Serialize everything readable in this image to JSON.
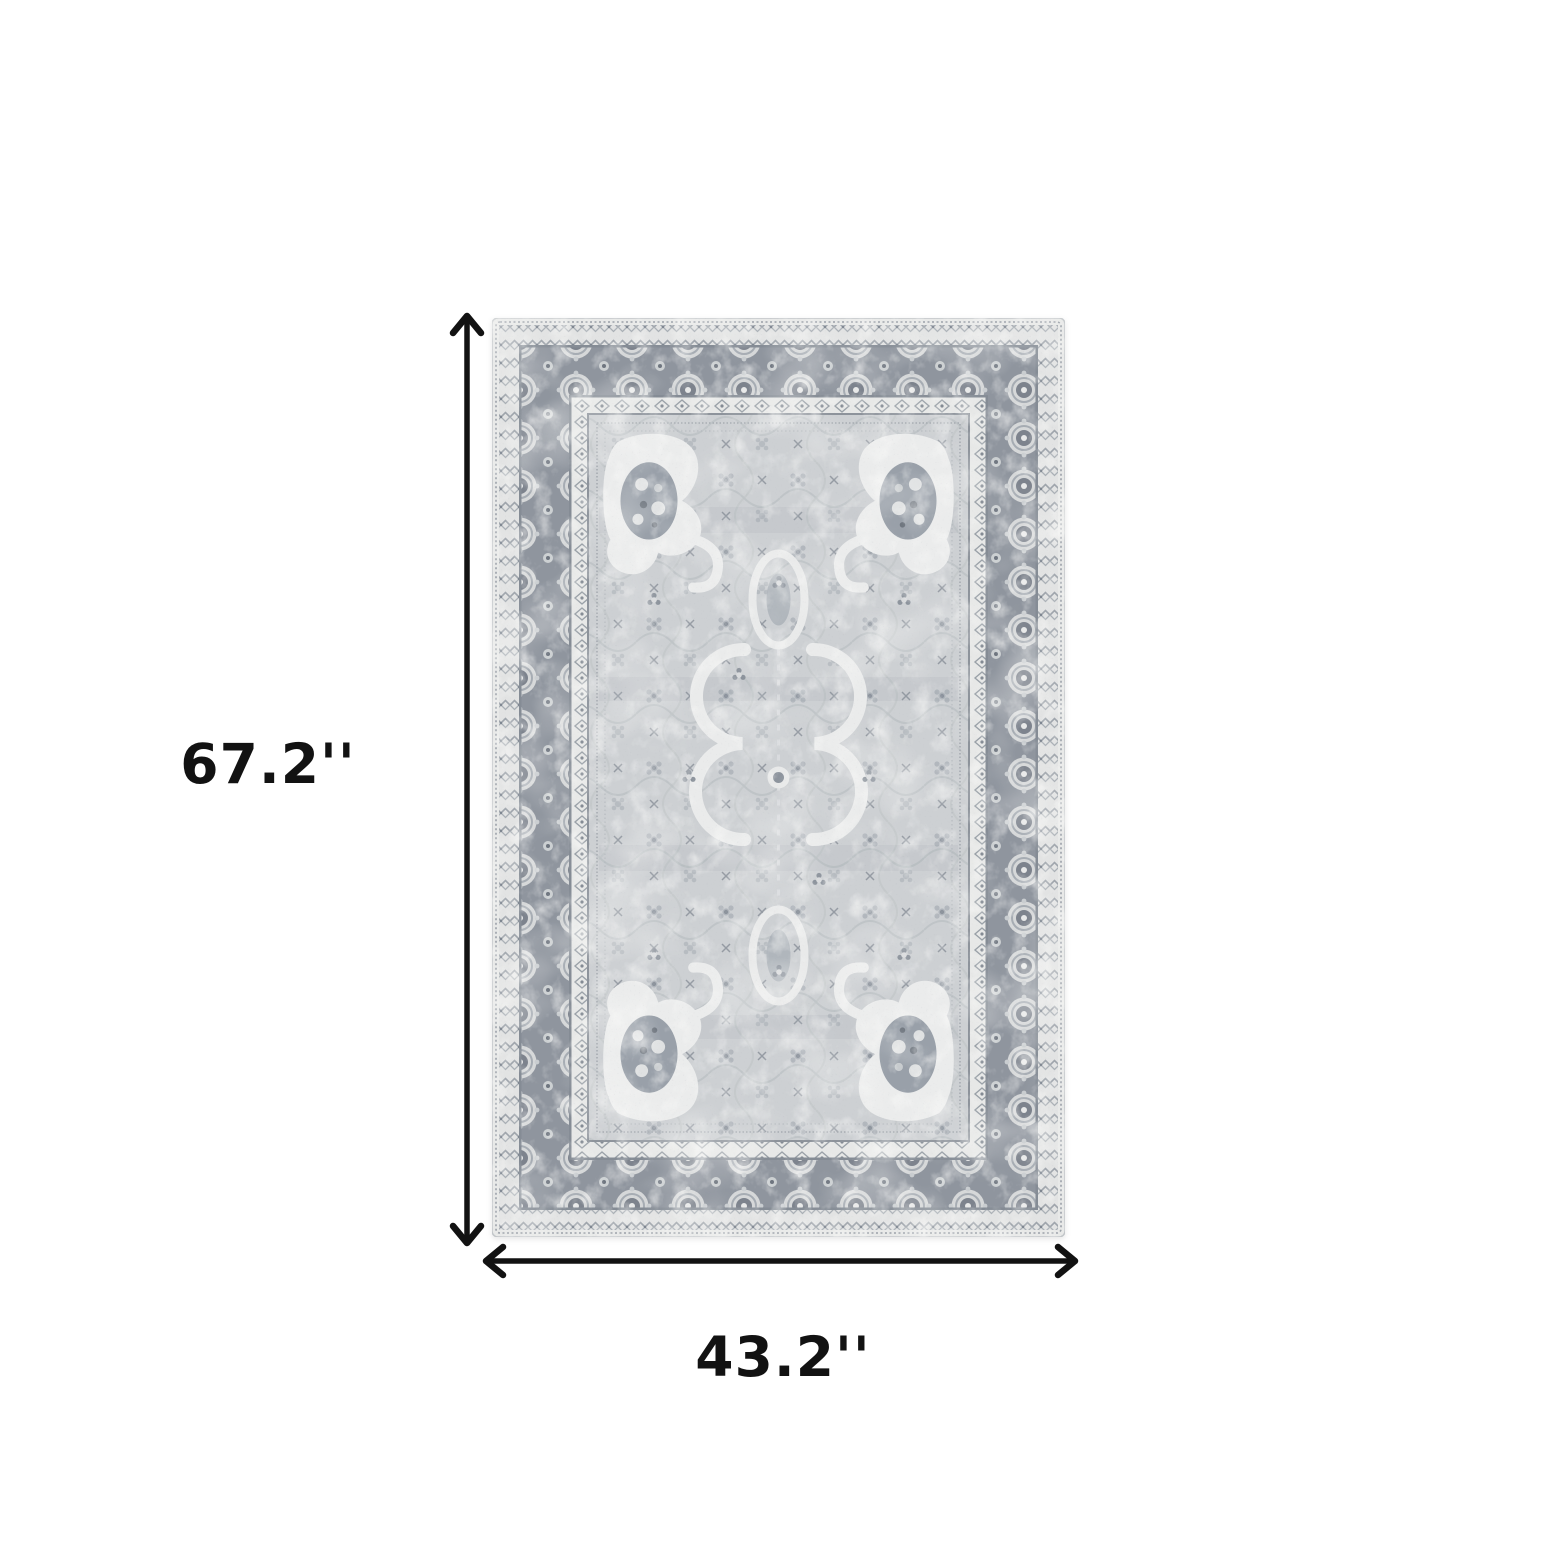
{
  "figure": {
    "type": "product-dimension-diagram",
    "background": "#ffffff",
    "annotation_color": "#121212",
    "height": {
      "label": "67.2''"
    },
    "width": {
      "label": "43.2''"
    },
    "rug": {
      "style": "distressed vintage oriental area rug, ornate floral borders with corner cartouches and scroll medallion field",
      "palette": {
        "base": "#e8e9e8",
        "field": "#cdd0d3",
        "border_band": "#8f959e",
        "motif_light": "#d9dbdc",
        "motif_dark": "#767d86",
        "cream": "#eceded",
        "line": "#8d939b"
      }
    }
  }
}
